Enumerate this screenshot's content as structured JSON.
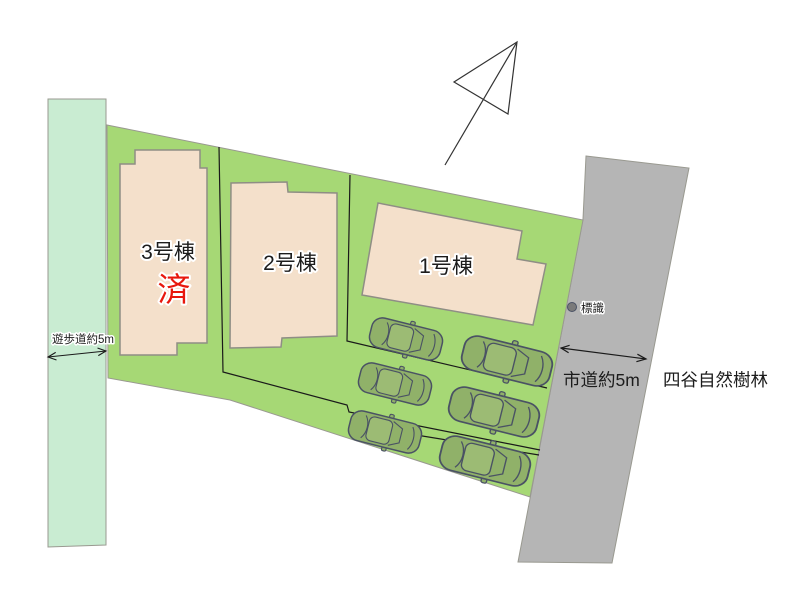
{
  "site": {
    "buildings": [
      {
        "label": "3号棟",
        "status": "済"
      },
      {
        "label": "2号棟"
      },
      {
        "label": "1号棟"
      }
    ],
    "walkway": {
      "label": "遊歩道約5m"
    },
    "road": {
      "label": "市道約5m"
    },
    "surroundings": {
      "forest_label": "四谷自然樹林"
    },
    "sign": {
      "label": "標識"
    },
    "parking": {
      "car_count": 6
    },
    "colors": {
      "plot_green": "#a6d875",
      "walkway_green": "#c9ecd2",
      "road_gray": "#b5b5b5",
      "edge_gray": "#999990",
      "building_fill": "#f4e0cb",
      "building_stroke": "#8f8e85",
      "car_green": "#90b169",
      "car_green_light": "#9cbb74",
      "car_outline": "#4a5264",
      "sold_red": "#e8170d",
      "line_black": "#1a1a1a",
      "text_black": "#1c1c1c",
      "sign_dot": "#7a7a7a"
    }
  }
}
